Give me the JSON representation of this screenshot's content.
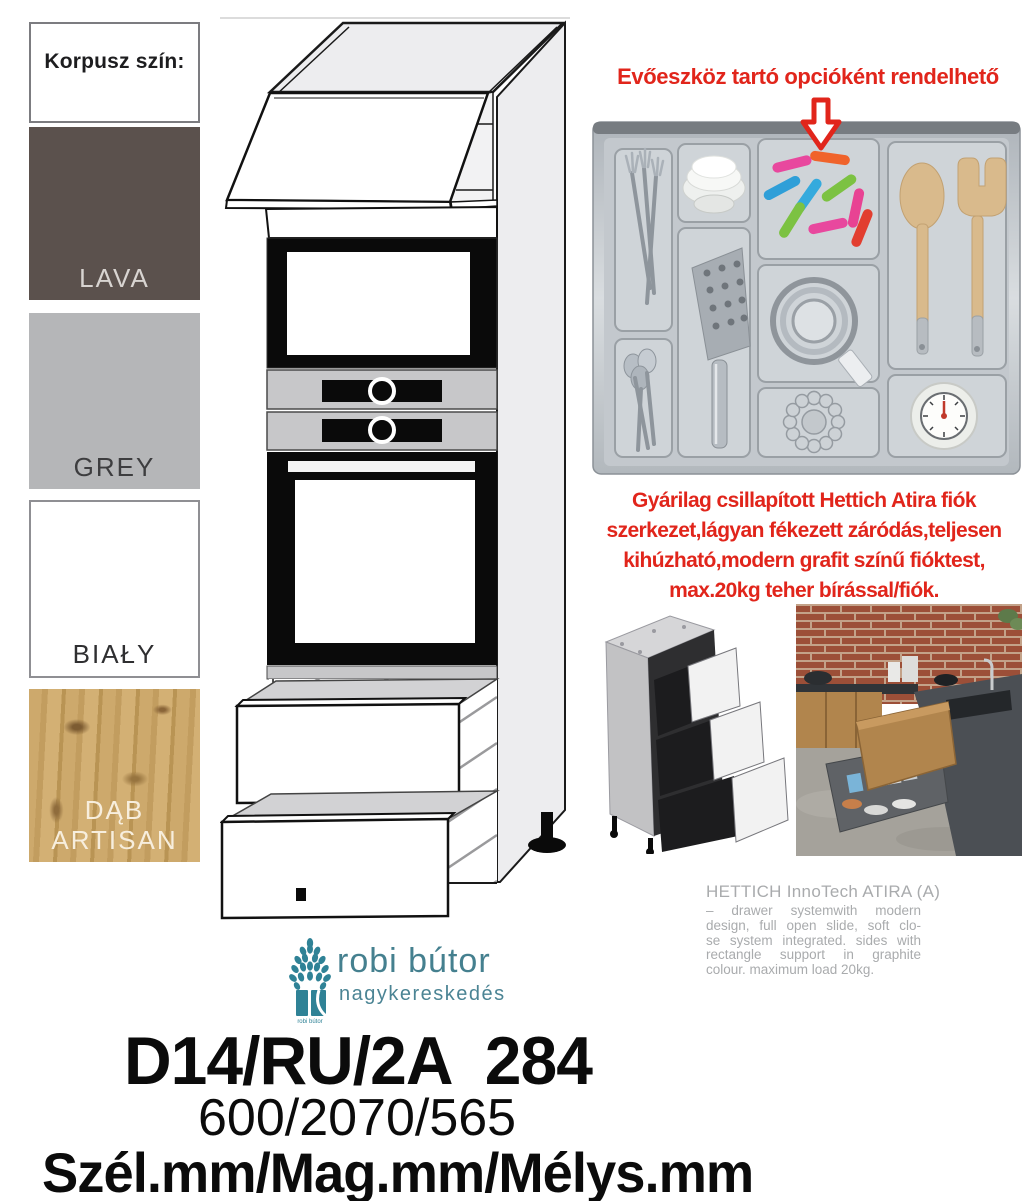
{
  "korpusz": {
    "title": "Korpusz szín:",
    "swatches": [
      {
        "label": "LAVA",
        "color": "#5b514d"
      },
      {
        "label": "GREY",
        "color": "#b5b6b8"
      },
      {
        "label": "BIAŁY",
        "color": "#ffffff"
      },
      {
        "label": "DĄB ARTISAN",
        "color": "#c9a466",
        "label_lines": [
          "DĄB",
          "ARTISAN"
        ]
      }
    ]
  },
  "cutlery_option": {
    "title": "Evőeszköz tartó opcióként rendelhető",
    "accent_color": "#e1251b",
    "arrow_icon": "down-arrow"
  },
  "drawer_info": {
    "lines": [
      "Gyárilag csillapított Hettich Atira fiók",
      "szerkezet,lágyan fékezett záródás,teljesen",
      "kihúzható,modern grafit színű fióktest,",
      "max.20kg teher bírással/fiók."
    ]
  },
  "hettich": {
    "title": "HETTICH InnoTech ATIRA (A)",
    "lines": [
      "– drawer systemwith modern",
      "design, full open slide, soft clo-",
      "se system integrated. sides with",
      "rectangle support in graphite",
      "colour. maximum load 20kg."
    ],
    "text_color": "#a9abad"
  },
  "logo": {
    "name": "robi bútor",
    "subtitle": "nagykereskedés",
    "icon_caption": "robi bútor",
    "teal": "#45808f"
  },
  "product": {
    "code": "D14/RU/2A  284",
    "dimensions": "600/2070/565",
    "dimension_labels": "Szél.mm/Mag.mm/Mélys.mm"
  }
}
